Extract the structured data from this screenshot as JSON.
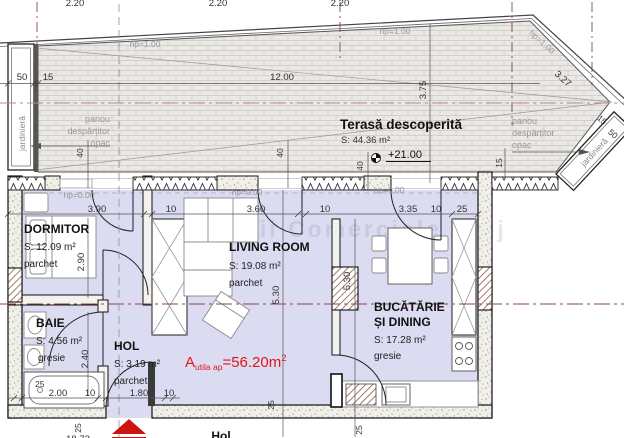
{
  "rooms": {
    "dormitor": {
      "name": "DORMITOR",
      "area": "S: 12.09 m²",
      "floor": "parchet"
    },
    "baie": {
      "name": "BAIE",
      "area": "S: 4.56 m²",
      "floor": "gresie"
    },
    "hol": {
      "name": "HOL",
      "area": "S: 3.19 m²",
      "floor": "parchet"
    },
    "living": {
      "name": "LIVING ROOM",
      "area": "S: 19.08 m²",
      "floor": "parchet"
    },
    "bucatarie": {
      "name_line1": "BUCĂTĂRIE",
      "name_line2": "ȘI DINING",
      "area": "S: 17.28 m²",
      "floor": "gresie"
    },
    "terasa": {
      "name": "Terasă descoperită",
      "area": "S: 44.36 m²",
      "level": "+21.00"
    }
  },
  "total_area": {
    "a": "A",
    "sub": "utila ap",
    "eq": "=56.20m",
    "sup": "2"
  },
  "dims": {
    "top_axis": [
      "2.20",
      "2.20",
      "2.20"
    ],
    "terrace": {
      "w50": "50",
      "w15": "15",
      "w1200": "12.00",
      "v375": "3.75",
      "d327": "3.27",
      "f40": "40",
      "f15": "15",
      "c15": "15",
      "c50": "50"
    },
    "row_top": [
      "3.90",
      "10",
      "3.60",
      "10",
      "3.35",
      "10",
      "25"
    ],
    "row_bottom": [
      "25",
      "2.00",
      "10",
      "1.80",
      "10"
    ],
    "v290": "2.90",
    "v240": "2.40",
    "v530": "5.30",
    "b25": "25",
    "total_width": "18.72"
  },
  "annotations": {
    "hp100": "hp=1.00",
    "hp000": "hp=0.00",
    "panou_l1": "panou",
    "panou_l2": "despărțitor",
    "panou_l3": "opac",
    "jardiniera": "jardinieră",
    "hol_exterior": "Hol"
  },
  "watermark": {
    "text": "Spatii Comerciale Cluj"
  },
  "colors": {
    "floor": "#dbdbf1",
    "accent_red": "#e31515",
    "axis": "#8b4545",
    "entrance_arrow": "#cc1511"
  }
}
